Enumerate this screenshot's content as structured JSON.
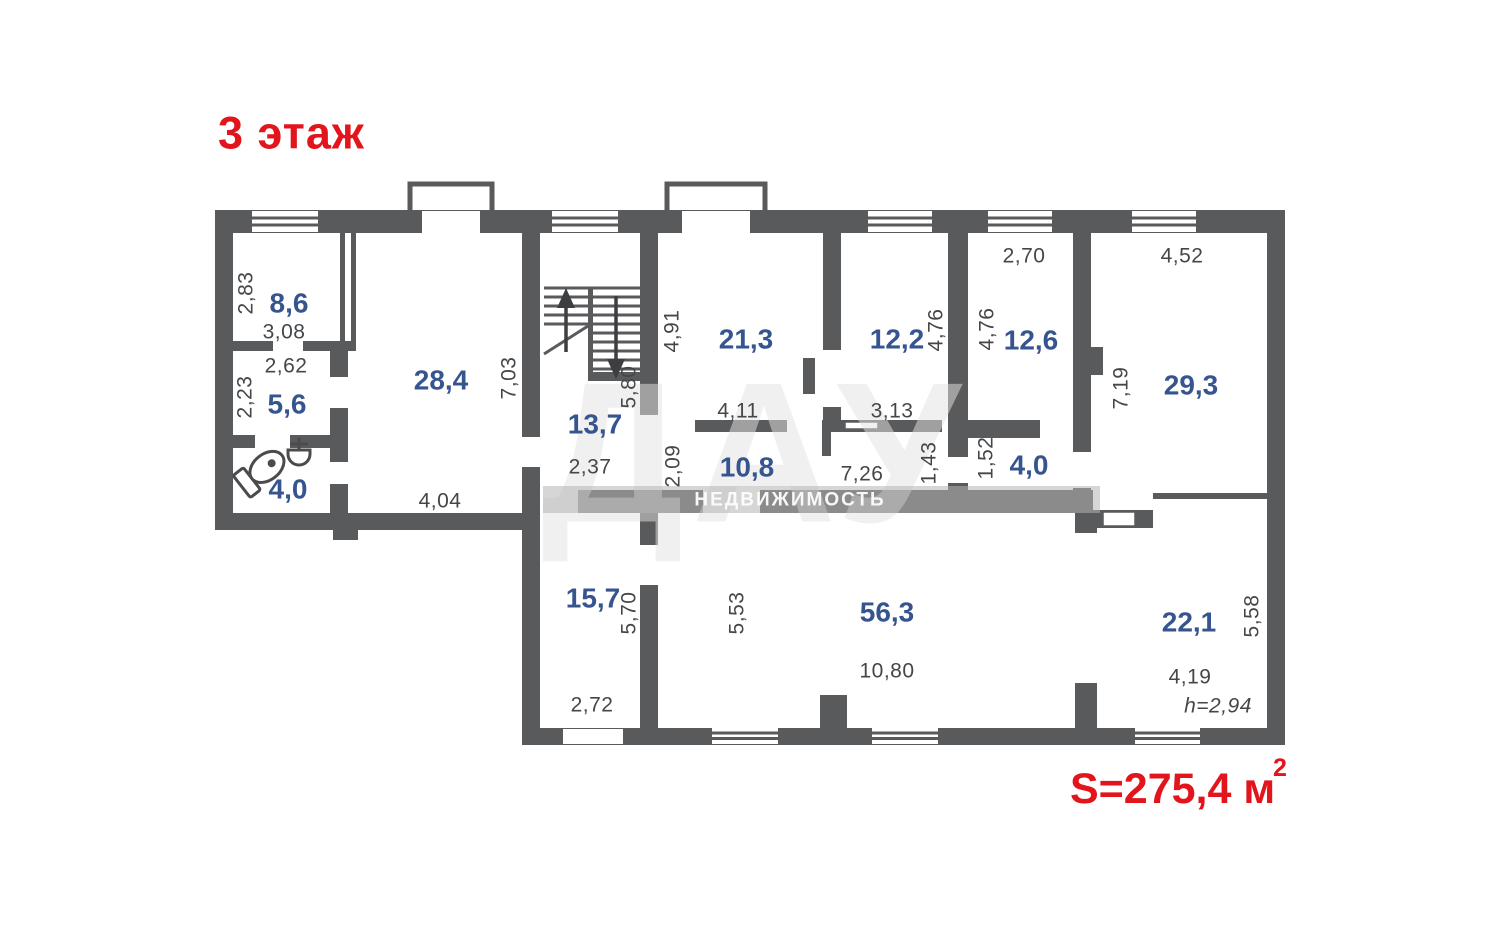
{
  "title": "3 этаж",
  "total": {
    "text": "S=275,4 м",
    "sup": "2"
  },
  "watermark": {
    "big": "ДАУ",
    "band": "НЕДВИЖИМОСТЬ"
  },
  "colors": {
    "wall": "#595a5c",
    "room_label": "#36558e",
    "dim_label": "#44474a",
    "accent_red": "#e2151c"
  },
  "rooms": [
    {
      "area": "8,6"
    },
    {
      "area": "5,6"
    },
    {
      "area": "4,0"
    },
    {
      "area": "28,4"
    },
    {
      "area": "13,7"
    },
    {
      "area": "21,3"
    },
    {
      "area": "12,2"
    },
    {
      "area": "12,6"
    },
    {
      "area": "29,3"
    },
    {
      "area": "10,8"
    },
    {
      "area": "4,0"
    },
    {
      "area": "15,7"
    },
    {
      "area": "56,3"
    },
    {
      "area": "22,1"
    }
  ],
  "dims": [
    {
      "value": "2,83"
    },
    {
      "value": "3,08"
    },
    {
      "value": "2,62"
    },
    {
      "value": "2,23"
    },
    {
      "value": "4,04"
    },
    {
      "value": "7,03"
    },
    {
      "value": "5,80"
    },
    {
      "value": "2,37"
    },
    {
      "value": "4,91"
    },
    {
      "value": "4,11"
    },
    {
      "value": "2,09"
    },
    {
      "value": "7,26"
    },
    {
      "value": "3,13"
    },
    {
      "value": "1,43"
    },
    {
      "value": "4,76"
    },
    {
      "value": "4,76"
    },
    {
      "value": "2,70"
    },
    {
      "value": "4,52"
    },
    {
      "value": "7,19"
    },
    {
      "value": "1,52"
    },
    {
      "value": "5,70"
    },
    {
      "value": "2,72"
    },
    {
      "value": "5,53"
    },
    {
      "value": "10,80"
    },
    {
      "value": "5,58"
    },
    {
      "value": "4,19"
    },
    {
      "value": "h=2,94"
    }
  ]
}
